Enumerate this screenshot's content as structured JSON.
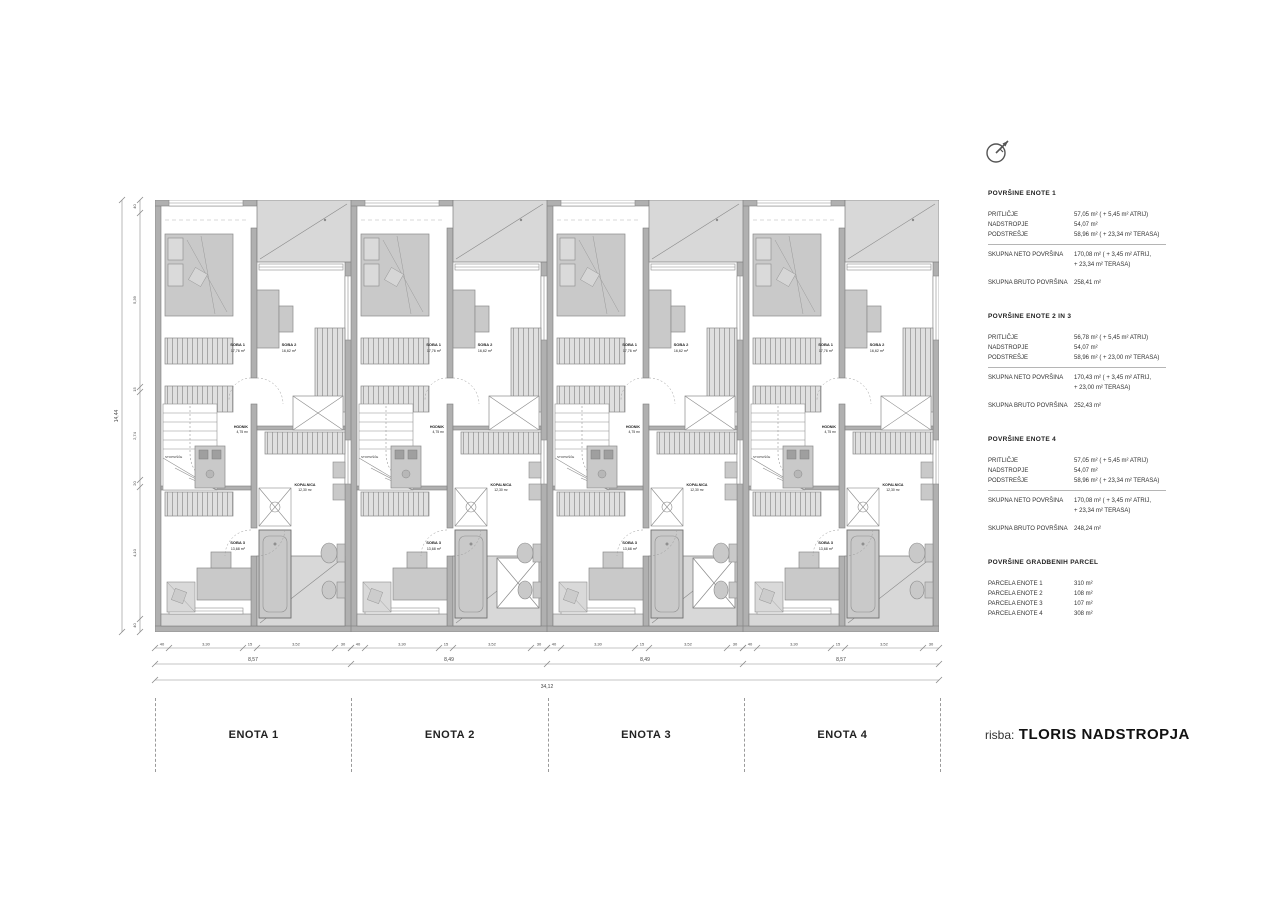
{
  "drawing": {
    "title_prefix": "risba:",
    "title": "TLORIS NADSTROPJA"
  },
  "units": [
    {
      "label": "ENOTA 1",
      "cross_void": false
    },
    {
      "label": "ENOTA 2",
      "cross_void": true
    },
    {
      "label": "ENOTA 3",
      "cross_void": true
    },
    {
      "label": "ENOTA 4",
      "cross_void": false
    }
  ],
  "plan": {
    "rooms": {
      "soba1": {
        "name": "SOBA 1",
        "area": "17,76 m²"
      },
      "soba2": {
        "name": "SOBA 2",
        "area": "16,62 m²"
      },
      "hodnik": {
        "name": "HODNIK",
        "area": "4,75 m²"
      },
      "kopalnica": {
        "name": "KOPALNICA",
        "area": "12,30 m²"
      },
      "soba3": {
        "name": "SOBA 3",
        "area": "13,68 m²"
      },
      "stopnisce": {
        "name": "STOPNIŠČE",
        "area": ""
      }
    }
  },
  "dimensions": {
    "unit_sub_segments": [
      "40",
      "3,30",
      "15",
      "3,52",
      "30"
    ],
    "horizontal_segments": [
      "8,57",
      "8,49",
      "8,49",
      "8,57"
    ],
    "horizontal_total": "34,12",
    "vertical_segments": [
      "40",
      "5,39",
      "15",
      "2,74",
      "20",
      "4,10",
      "40"
    ],
    "vertical_total": "14,44"
  },
  "area_tables": [
    {
      "title": "POVRŠINE ENOTE 1",
      "rows": [
        {
          "label": "PRITLIČJE",
          "value": "57,05 m² ( + 5,45 m² ATRIJ)"
        },
        {
          "label": "NADSTROPJE",
          "value": "54,07 m²"
        },
        {
          "label": "PODSTREŠJE",
          "value": "58,96 m² ( + 23,34 m² TERASA)"
        }
      ],
      "totals": [
        {
          "label": "SKUPNA NETO POVRŠINA",
          "value": "170,08 m² ( + 3,45 m² ATRIJ,\n+ 23,34 m² TERASA)"
        },
        {
          "label": "SKUPNA BRUTO POVRŠINA",
          "value": "258,41 m²"
        }
      ]
    },
    {
      "title": "POVRŠINE ENOTE 2 IN 3",
      "rows": [
        {
          "label": "PRITLIČJE",
          "value": "56,78 m² ( + 5,45 m² ATRIJ)"
        },
        {
          "label": "NADSTROPJE",
          "value": "54,07 m²"
        },
        {
          "label": "PODSTREŠJE",
          "value": "58,96 m² ( + 23,00 m² TERASA)"
        }
      ],
      "totals": [
        {
          "label": "SKUPNA NETO POVRŠINA",
          "value": "170,43 m² ( + 3,45 m² ATRIJ,\n+ 23,00 m² TERASA)"
        },
        {
          "label": "SKUPNA BRUTO POVRŠINA",
          "value": "252,43 m²"
        }
      ]
    },
    {
      "title": "POVRŠINE ENOTE 4",
      "rows": [
        {
          "label": "PRITLIČJE",
          "value": "57,05 m² ( + 5,45 m² ATRIJ)"
        },
        {
          "label": "NADSTROPJE",
          "value": "54,07 m²"
        },
        {
          "label": "PODSTREŠJE",
          "value": "58,96 m² ( + 23,34 m² TERASA)"
        }
      ],
      "totals": [
        {
          "label": "SKUPNA NETO POVRŠINA",
          "value": "170,08 m² ( + 3,45 m² ATRIJ,\n+ 23,34 m² TERASA)"
        },
        {
          "label": "SKUPNA BRUTO POVRŠINA",
          "value": "248,24 m²"
        }
      ]
    }
  ],
  "parcel_table": {
    "title": "POVRŠINE GRADBENIH PARCEL",
    "rows": [
      {
        "label": "PARCELA ENOTE 1",
        "value": "310 m²"
      },
      {
        "label": "PARCELA ENOTE 2",
        "value": "108 m²"
      },
      {
        "label": "PARCELA ENOTE 3",
        "value": "107 m²"
      },
      {
        "label": "PARCELA ENOTE 4",
        "value": "308 m²"
      }
    ]
  },
  "colors": {
    "wall": "#b0b0b0",
    "wall_edge": "#7d7d7d",
    "furniture": "#c9c9c9",
    "terrace": "#d8d8d8",
    "line": "#8a8a8a",
    "text": "#1a1a1a"
  }
}
